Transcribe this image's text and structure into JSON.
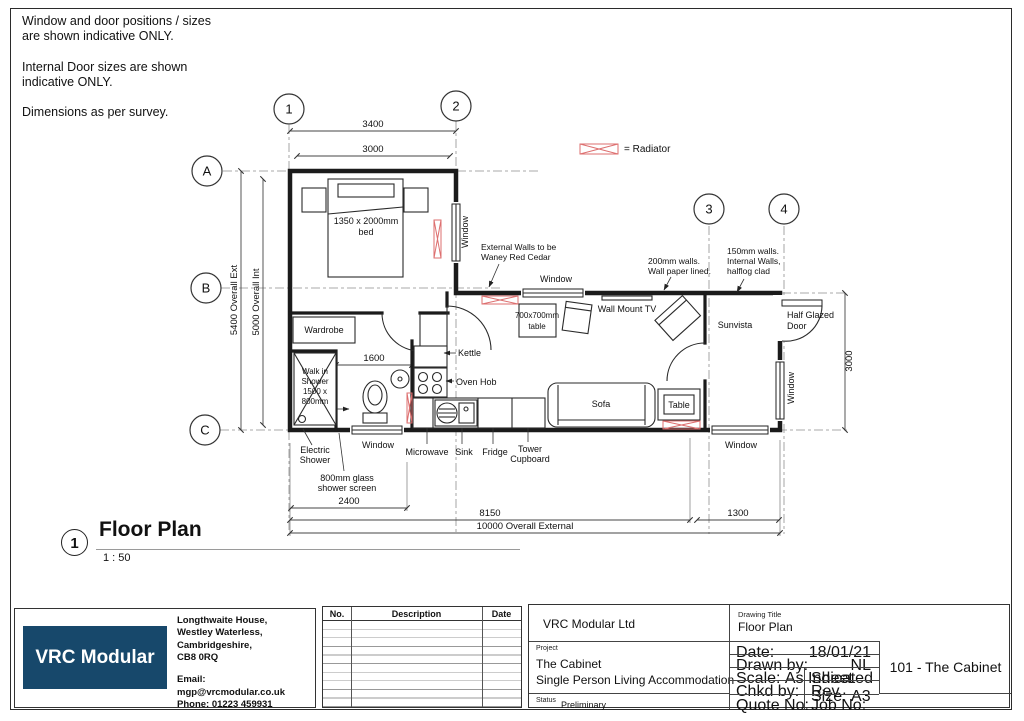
{
  "notes": [
    [
      "Window and door positions / sizes",
      "are shown indicative ONLY."
    ],
    [
      "Internal Door sizes are shown",
      "indicative ONLY."
    ],
    [
      "Dimensions as per survey."
    ]
  ],
  "legend": {
    "radiator": "= Radiator"
  },
  "grid": {
    "cols": [
      "1",
      "2",
      "3",
      "4"
    ],
    "rows": [
      "A",
      "B",
      "C"
    ]
  },
  "dims": {
    "top_ext": "3400",
    "top_int": "3000",
    "left_ext": "5400 Overall Ext",
    "left_int": "5000 Overall Int",
    "hall": "1600",
    "right": "3000",
    "shower": "2400",
    "main": "8150",
    "sunvista": "1300",
    "overall": "10000 Overall External"
  },
  "rooms": {
    "bed": [
      "1350 x 2000mm",
      "bed"
    ],
    "wardrobe": "Wardrobe",
    "walk_in_shower": [
      "Walk in",
      "Shower",
      "1500 x",
      "800mm"
    ],
    "electric_shower": [
      "Electric",
      "Shower"
    ],
    "shower_screen": [
      "800mm glass",
      "shower screen"
    ],
    "window": "Window",
    "kettle": "Kettle",
    "oven_hob": "Oven Hob",
    "microwave": "Microwave",
    "sink": "Sink",
    "fridge": "Fridge",
    "tower_cupboard": [
      "Tower",
      "Cupboard"
    ],
    "table_700": [
      "700x700mm",
      "table"
    ],
    "wall_mount_tv": "Wall Mount TV",
    "sofa": "Sofa",
    "table": "Table",
    "sunvista": "Sunvista",
    "half_glazed_door": [
      "Half Glazed",
      "Door"
    ]
  },
  "annotations": {
    "external_walls": [
      "External Walls to be",
      "Waney Red Cedar"
    ],
    "walls_200": [
      "200mm walls.",
      "Wall paper lined."
    ],
    "walls_150": [
      "150mm walls.",
      "Internal Walls,",
      "halflog clad"
    ]
  },
  "view_title": {
    "number": "1",
    "name": "Floor Plan",
    "scale": "1 : 50"
  },
  "titleblock": {
    "logo": "VRC Modular Ltd",
    "address": [
      "Longthwaite House,",
      "Westley Waterless,",
      "Cambridgeshire,",
      "CB8 0RQ"
    ],
    "email": "Email: mgp@vrcmodular.co.uk",
    "phone": "Phone: 01223 459931",
    "rev": {
      "no": "No.",
      "description": "Description",
      "date": "Date"
    },
    "company": "VRC Modular Ltd",
    "project_label": "Project",
    "project_name": "The Cabinet",
    "project_desc": "Single Person Living Accommodation",
    "status_label": "Status",
    "status_value": "Preliminary",
    "drawing_title_label": "Drawing Title",
    "drawing_title": "Floor Plan",
    "date_label": "Date:",
    "date_value": "18/01/21",
    "drawn_label": "Drawn by:",
    "drawn_value": "NL",
    "scale_label": "Scale:",
    "scale_value": "As Indicated",
    "sheet_label": "Sheet Size:",
    "sheet_value": "A3",
    "chkd_label": "Chkd by:",
    "rev_label": "Rev",
    "quote_label": "Quote No:",
    "job_label": "Job No:",
    "drawing_number": "101 - The Cabinet"
  },
  "colors": {
    "brand_blue": "#17486b",
    "radiator_red": "#dd6f6f"
  }
}
